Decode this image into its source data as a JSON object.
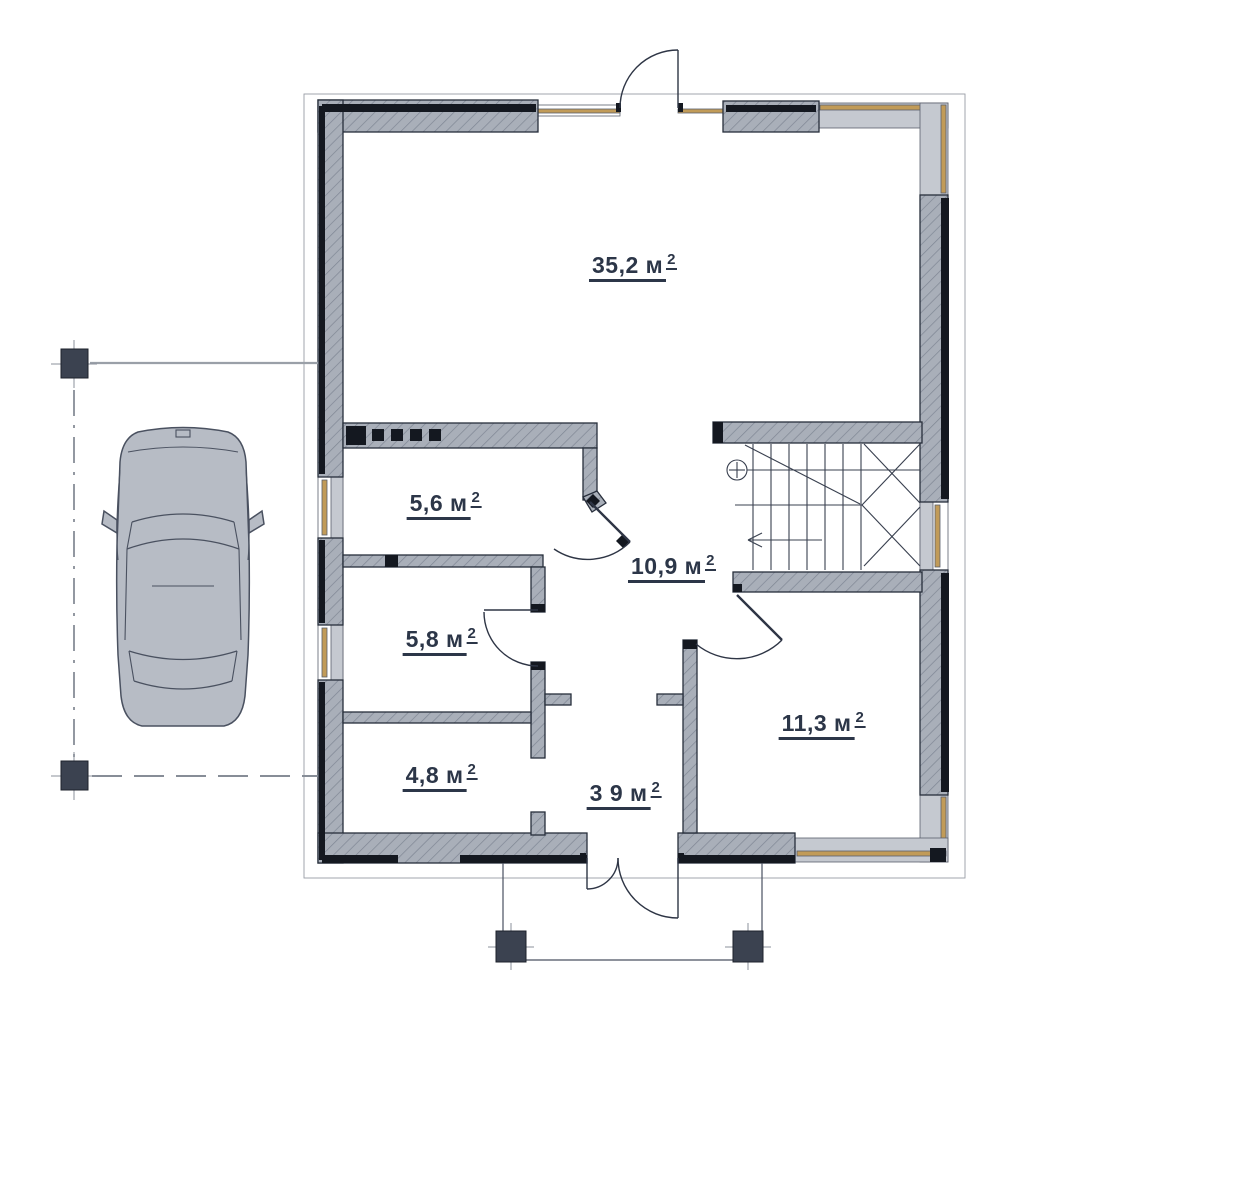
{
  "plan": {
    "kind": "first-floor architectural plan",
    "rooms": [
      {
        "id": "room-1",
        "label": "35,2 м",
        "sup": "2"
      },
      {
        "id": "room-2",
        "label": "5,6 м",
        "sup": "2"
      },
      {
        "id": "room-3",
        "label": "5,8 м",
        "sup": "2"
      },
      {
        "id": "room-4",
        "label": "4,8 м",
        "sup": "2"
      },
      {
        "id": "room-5",
        "label": "10,9 м",
        "sup": "2"
      },
      {
        "id": "room-6",
        "label": "3 9 м",
        "sup": "2"
      },
      {
        "id": "room-7",
        "label": "11,3 м",
        "sup": "2"
      }
    ],
    "elements": {
      "car": "car-top-view-icon",
      "stairs": "u-shaped-staircase",
      "doors": "door-swing-arcs",
      "columns": "square-post-markers",
      "windows": "glazed-wall-strips"
    },
    "colors": {
      "wall_fill": "#a9afb9",
      "wall_hatch": "#7f8694",
      "wall_outline": "#272e3b",
      "insulation_band": "#141820",
      "glazing": "#c5c9d0",
      "window_wood": "#c19b58",
      "column": "#3b4250",
      "car_body": "#b7bcc5",
      "thin_line": "#39404f",
      "axis_dash": "#878d97",
      "label_text": "#2c3648"
    }
  }
}
